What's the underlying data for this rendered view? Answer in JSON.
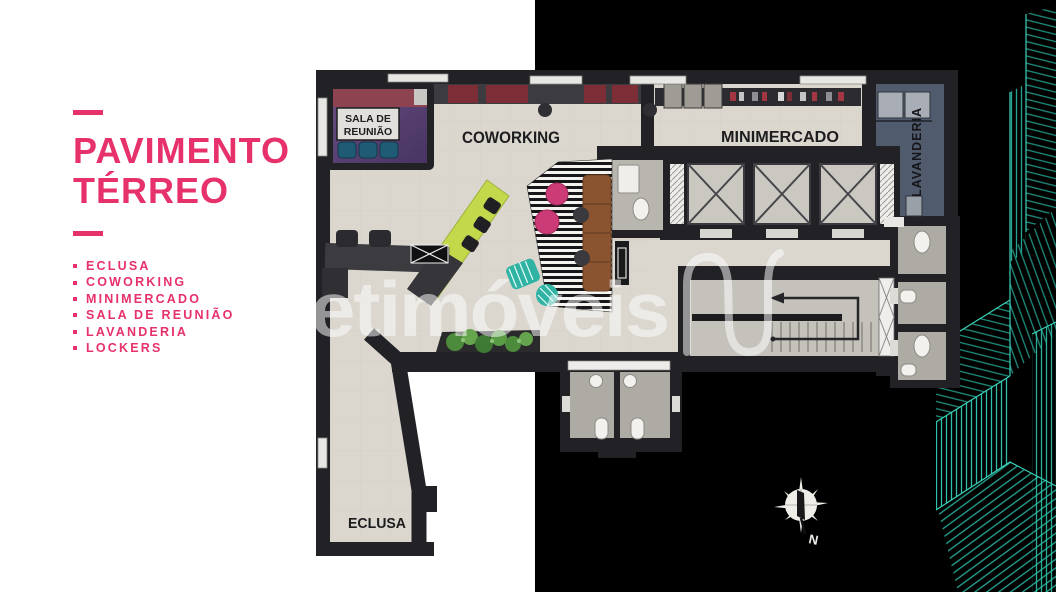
{
  "left_panel": {
    "title_line1": "PAVIMENTO",
    "title_line2": "TÉRREO",
    "features": [
      "ECLUSA",
      "COWORKING",
      "MINIMERCADO",
      "SALA DE REUNIÃO",
      "LAVANDERIA",
      "LOCKERS"
    ]
  },
  "floor_plan": {
    "labels": {
      "coworking": "COWORKING",
      "minimercado": "MINIMERCADO",
      "eclusa": "ECLUSA",
      "lavanderia": "LAVANDERIA",
      "sala_line1": "SALA DE",
      "sala_line2": "REUNIÃO"
    },
    "compass": {
      "north_label": "N"
    }
  },
  "watermark": {
    "text": "etimóveis",
    "logo": "netimoveis-n-logo"
  },
  "colors": {
    "accent_pink": "#E7316B",
    "wireframe_teal": "#2FBFA9",
    "right_background": "#000000",
    "floor_beige": "#DBD7CF",
    "wall_black": "#212126",
    "sala_purple": "#5A4170",
    "lavanderia_slate": "#505B6E",
    "lime_desk": "#C3D84B",
    "pouf_pink": "#CC3B76",
    "sofa_brown": "#8A5430"
  }
}
